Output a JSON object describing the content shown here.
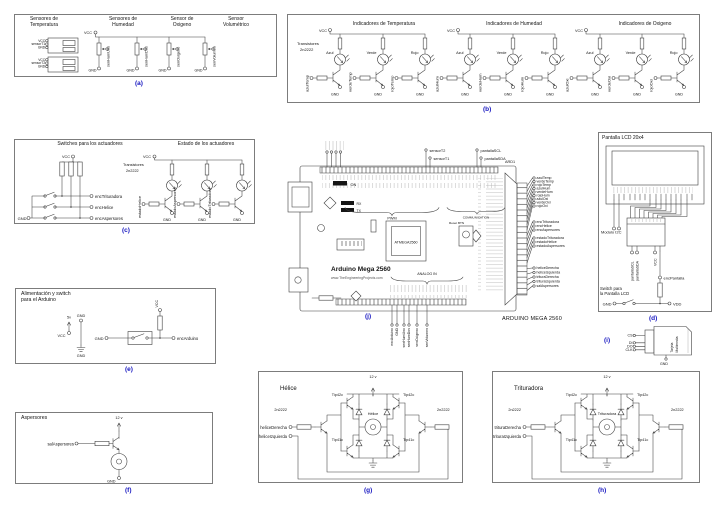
{
  "tags": {
    "a": "(a)",
    "b": "(b)",
    "c": "(c)",
    "d": "(d)",
    "e": "(e)",
    "f": "(f)",
    "g": "(g)",
    "h": "(h)",
    "i": "(i)",
    "j": "(j)"
  },
  "a": {
    "titles": [
      "Sensores de\nTemperatura",
      "Sensores de\nHumedad",
      "Sensor de\nOxigeno",
      "Sensor\nVolumétrico"
    ],
    "block1": [
      "VCC",
      "sensorT1",
      "GND"
    ],
    "block2": [
      "VCC",
      "sensorT2",
      "GND"
    ],
    "vcc": "VCC",
    "gnd": "GND",
    "pots": [
      "senHumUno",
      "senHumDos",
      "senOxigeno",
      "senVolumen"
    ]
  },
  "b": {
    "titles": [
      "Indicadores de Temperatura",
      "Indicadores de Humedad",
      "Indicadores de Oxigeno"
    ],
    "note1": "Transistores",
    "note2": "2n2222",
    "vcc": "VCC",
    "gnd": "GND",
    "colors": [
      "Azul",
      "Verde",
      "Rojo"
    ],
    "inputs": [
      "azulTemp",
      "verdeTemp",
      "rojoTemp",
      "azulHum",
      "verdeHum",
      "rojoHum",
      "azulOxi",
      "verdeOxi",
      "rojoOxi"
    ]
  },
  "c": {
    "titles": [
      "Switches para los actuadores",
      "Estado de los actuadores"
    ],
    "note1": "Transistores",
    "note2": "2n2222",
    "vcc": "VCC",
    "gnd": "GND",
    "outs": [
      "encTrituradora",
      "encHelice",
      "encAspersores"
    ],
    "ins": [
      "estadoHelice",
      "estadoAspersores",
      "estadoTrituradora"
    ]
  },
  "d": {
    "title": "Pantalla LCD 20x4",
    "module": "Modulo I2C",
    "scl": "pantallaSCL",
    "sda": "pantallaSDA",
    "vcc": "VCC",
    "enc": "encPantalla",
    "note": "Switch para\nla Pantalla LCD",
    "gnd": "GND",
    "vdd": "VDD"
  },
  "i": {
    "pins": [
      "CS",
      "DI",
      "DO",
      "CLK"
    ],
    "gnd": "GND",
    "card1": "Tarjeta",
    "card2": "Multimedia"
  },
  "e": {
    "title": "Alimentación y switch\npara el Arduino",
    "volt": "5v",
    "vcc": "VCC",
    "gnd": "GND",
    "out": "encArduino"
  },
  "f": {
    "title": "Aspersores",
    "input": "salAspersores",
    "v12": "12 v",
    "gnd": "GND"
  },
  "g": {
    "title": "Hélice",
    "motor": "Hélice",
    "v12": "12 v",
    "pnp": "Tip42c",
    "npn": "Tip41c",
    "drv": "2n2222",
    "in1": "heliceDerecha",
    "in2": "heliceIzquierda"
  },
  "h": {
    "title": "Trituradora",
    "motor": "Trituradora",
    "v12": "12 v",
    "pnp": "Tip42c",
    "npn": "Tip41c",
    "drv": "2n2222",
    "in1": "trituraDerecha",
    "in2": "trituraIzquierda"
  },
  "j": {
    "ref": "ARD1",
    "board": "Arduino Mega 2560",
    "url": "www.TheEngineeringProjects.com",
    "chip": "ATMEGA2560",
    "caption": "ARDUINO MEGA 2560",
    "on": "ON",
    "rx": "RX",
    "tx": "TX",
    "pwm": "PWM",
    "comm": "COMMUNICATION",
    "analog": "ANALOG IN",
    "reset": "Reset BTN",
    "top_pins": [
      "sensorT2",
      "sensorT1",
      "pantallaSCL",
      "pantallaSDA"
    ],
    "bottom_pins": [
      "encArduino",
      "GND",
      "senHumUno",
      "senHumDos",
      "senOxigeno",
      "senVolumen"
    ],
    "right_pins": [
      "azulTemp",
      "verdeTemp",
      "rojoTemp",
      "azulHum",
      "verdeHum",
      "rojoHum",
      "azulOxi",
      "verdeOxi",
      "rojoOxi",
      "encTrituradora",
      "encHelice",
      "encAspersores",
      "estadoTrituradora",
      "estadoHelice",
      "estadoAspersores",
      "heliceDerecha",
      "heliceIzquierda",
      "trituraDerecha",
      "trituraIzquierda",
      "salAspersores"
    ]
  }
}
